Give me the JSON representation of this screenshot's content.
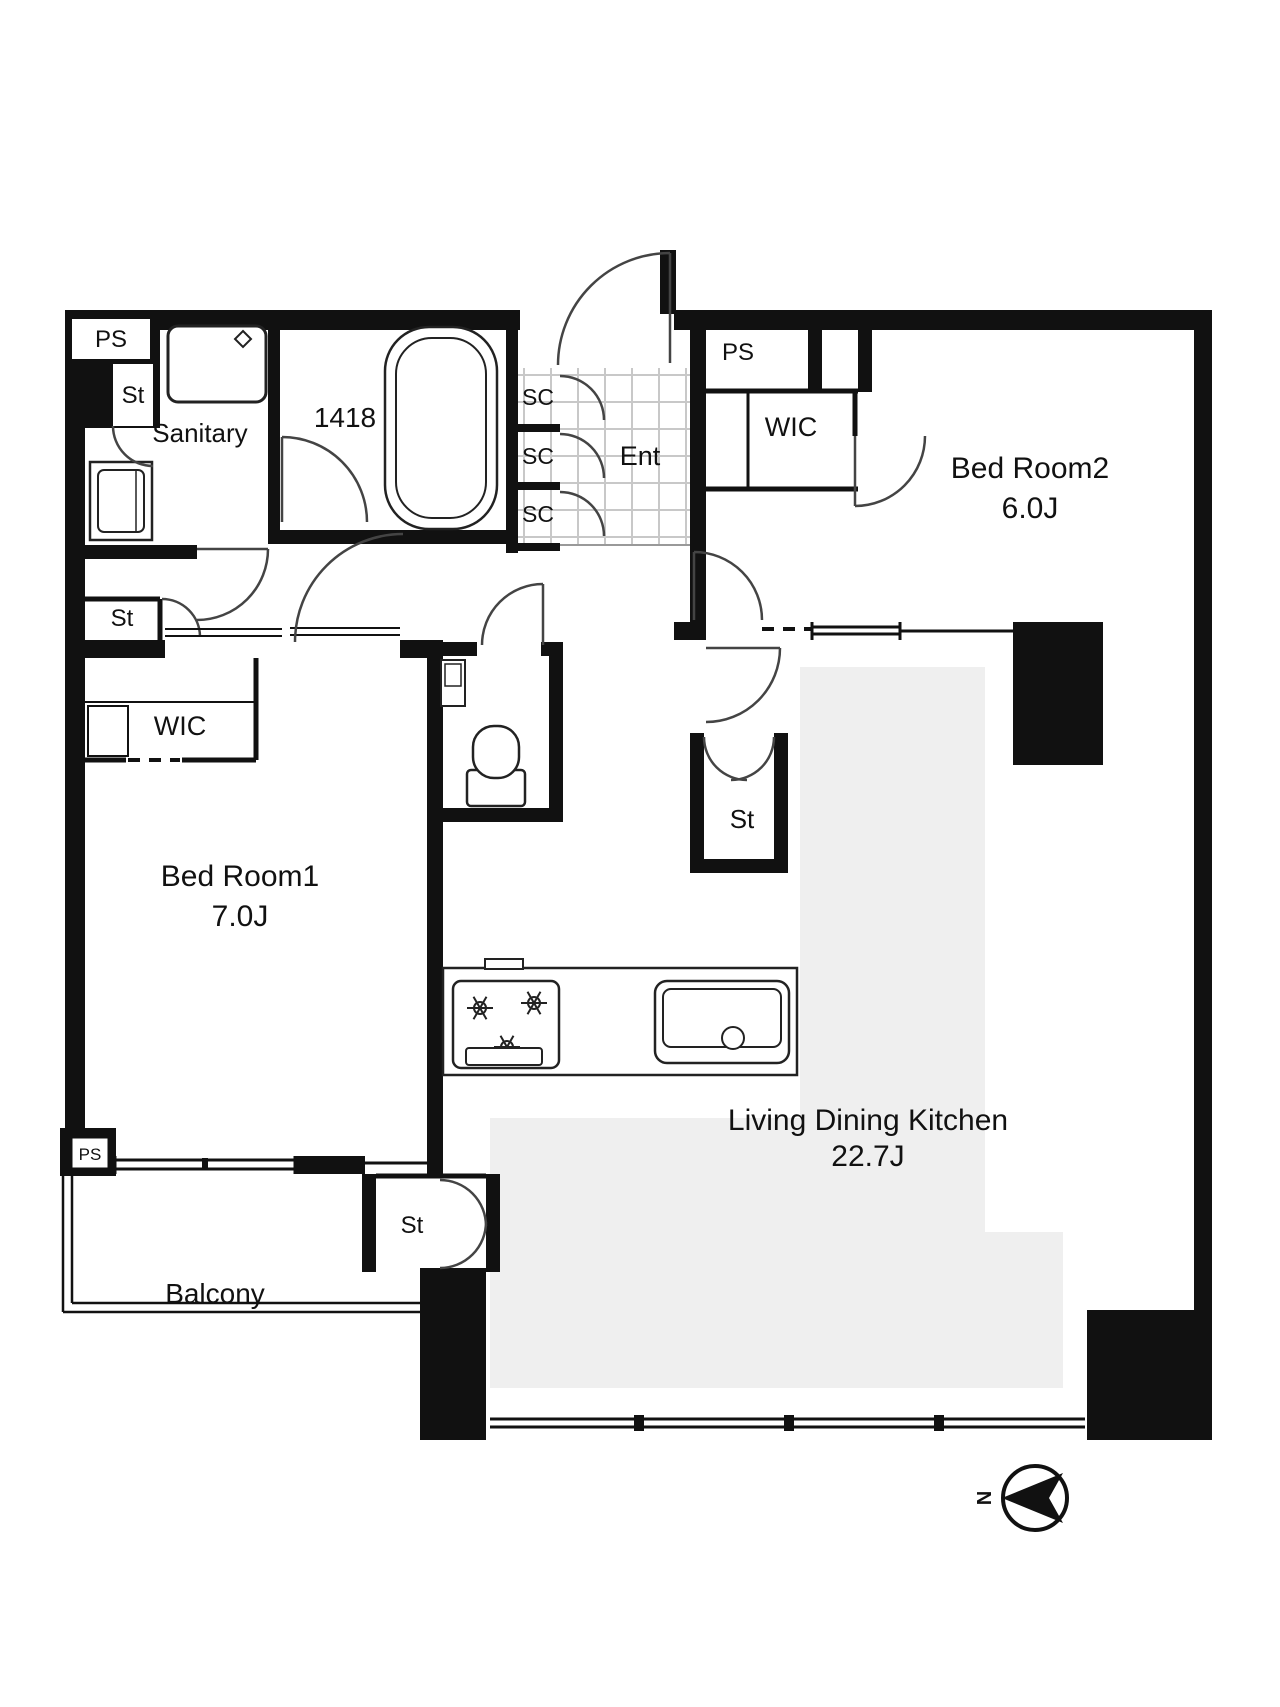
{
  "plan": {
    "labels": {
      "ps": "PS",
      "st": "St",
      "sc": "SC",
      "wic": "WIC",
      "ent": "Ent",
      "sanitary": "Sanitary",
      "bath_size": "1418",
      "balcony": "Balcony",
      "compass_north": "N"
    },
    "rooms": {
      "bedroom2": {
        "name": "Bed Room2",
        "area": "6.0J"
      },
      "bedroom1": {
        "name": "Bed Room1",
        "area": "7.0J"
      },
      "ldk": {
        "name": "Living Dining Kitchen",
        "area": "22.7J"
      }
    },
    "colors": {
      "wall": "#111111",
      "background": "#ffffff",
      "ldk_floor": "#efefef",
      "tile_line": "#c8c8c8",
      "door_line": "#444444"
    }
  }
}
